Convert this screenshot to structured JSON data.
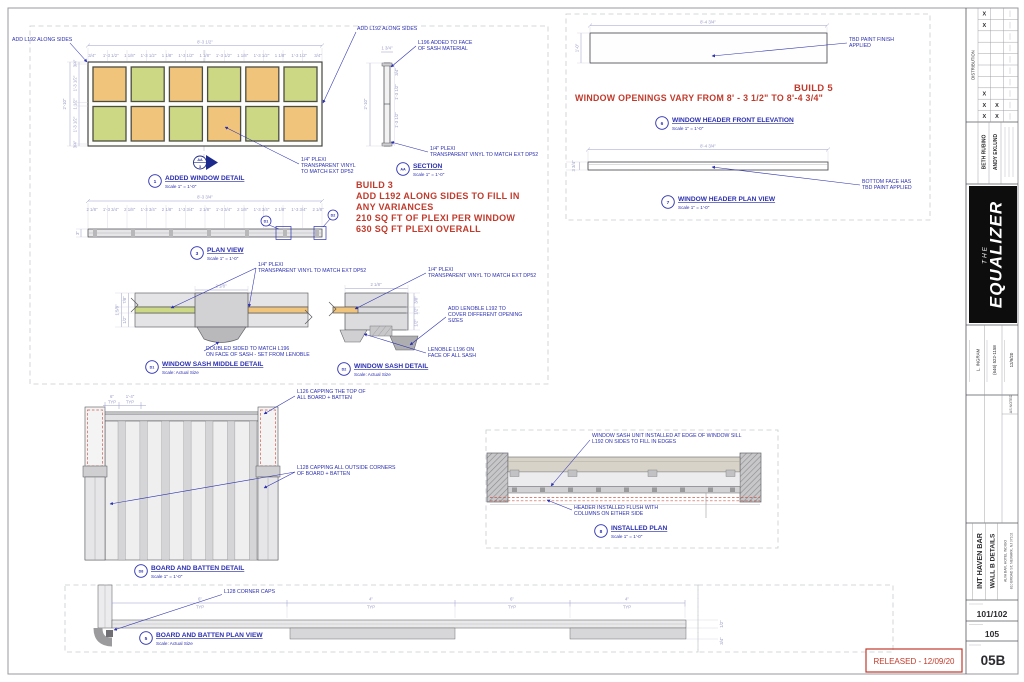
{
  "sheet": {
    "released": "RELEASED - 12/09/20"
  },
  "red": {
    "build3": [
      "BUILD 3",
      "ADD L192 ALONG SIDES TO FILL IN",
      "ANY VARIANCES",
      "210 SQ FT OF PLEXI PER WINDOW",
      "630 SQ FT PLEXI OVERALL"
    ],
    "build5_title": "BUILD 5",
    "build5_note": "WINDOW OPENINGS VARY FROM 8' - 3 1/2\" TO 8'-4 3/4\""
  },
  "details": {
    "added_window": {
      "num": "1",
      "title": "ADDED WINDOW DETAIL",
      "scale": "Scale 1\" = 1'-0\""
    },
    "section": {
      "num": "AA",
      "title": "SECTION",
      "scale": "Scale 1\" = 1'-0\""
    },
    "plan_view": {
      "num": "3",
      "title": "PLAN VIEW",
      "scale": "Scale 1\" = 1'-0\""
    },
    "sash_middle": {
      "num": "D1",
      "title": "WINDOW SASH MIDDLE DETAIL",
      "scale": "Scale: Actual Size"
    },
    "sash": {
      "num": "D2",
      "title": "WINDOW SASH DETAIL",
      "scale": "Scale: Actual Size"
    },
    "header_front": {
      "num": "6",
      "title": "WINDOW HEADER FRONT ELEVATION",
      "scale": "Scale 1\" = 1'-0\""
    },
    "header_plan": {
      "num": "7",
      "title": "WINDOW HEADER PLAN VIEW",
      "scale": "Scale 1\" = 1'-0\""
    },
    "bnb": {
      "num": "D8",
      "title": "BOARD AND BATTEN DETAIL",
      "scale": "Scale 1\" = 1'-0\""
    },
    "installed": {
      "num": "8",
      "title": "INSTALLED PLAN",
      "scale": "Scale 1\" = 1'-0\""
    },
    "bnb_plan": {
      "num": "5",
      "title": "BOARD AND BATTEN PLAN VIEW",
      "scale": "Scale: Actual Size"
    }
  },
  "section_marker": {
    "top": "AA",
    "bottom": "3"
  },
  "callouts": {
    "d1_tag": "D1",
    "d2_tag": "D2"
  },
  "notes": {
    "add_l192_a": "ADD L192 ALONG SIDES",
    "add_l192_b": "ADD L192 ALONG SIDES",
    "l196_face": [
      "L196 ADDED TO FACE",
      "OF SASH MATERIAL"
    ],
    "plexi_win": [
      "1/4\" PLEXI",
      "TRANSPARENT VINYL",
      "TO MATCH EXT DP52"
    ],
    "plexi_sec": [
      "1/4\" PLEXI",
      "TRANSPARENT VINYL TO MATCH EXT DP52"
    ],
    "plexi_d1": [
      "1/4\" PLEXI",
      "TRANSPARENT VINYL TO MATCH EXT DP52"
    ],
    "doubled": [
      "DOUBLED SIDED TO MATCH L196",
      "ON FACE OF SASH - SET FROM LENOBLE"
    ],
    "plexi_d2": [
      "1/4\" PLEXI",
      "TRANSPARENT VINYL TO MATCH EXT DP52"
    ],
    "lenoble_cover": [
      "ADD LENOBLE L192 TO",
      "COVER DIFFERENT OPENING",
      "SIZES"
    ],
    "lenoble_face": [
      "LENOBLE L196 ON",
      "FACE OF ALL SASH"
    ],
    "tbd_paint": [
      "TBD PAINT FINISH",
      "APPLIED"
    ],
    "bottom_face": [
      "BOTTOM FACE HAS",
      "TBD PAINT APPLIED"
    ],
    "l126": [
      "L126 CAPPING THE TOP OF",
      "ALL BOARD + BATTEN"
    ],
    "l128_out": [
      "L128 CAPPING ALL OUTSIDE CORNERS",
      "OF BOARD + BATTEN"
    ],
    "sash_unit": [
      "WINDOW SASH UNIT INSTALLED AT EDGE OF WINDOW SILL",
      "L192 ON SIDES TO FILL IN EDGES"
    ],
    "header_flush": [
      "HEADER INSTALLED FLUSH WITH",
      "COLUMNS ON EITHER SIDE"
    ],
    "l128_caps": "L128 CORNER CAPS"
  },
  "dims": {
    "win_w": "8'-3 1/2\"",
    "win_top": [
      "3/4\"",
      "1'-3 1/2\"",
      "1 1/8\"",
      "1'-3 1/2\"",
      "1 1/8\"",
      "1'-3 1/2\"",
      "1 1/8\"",
      "1'-3 1/2\"",
      "1 1/8\"",
      "1'-3 1/2\"",
      "1 1/8\"",
      "1'-3 1/2\"",
      "3/4\""
    ],
    "win_h": "2'-10\"",
    "win_left": [
      "3/4\"",
      "1'-3 1/2\"",
      "1 1/2\"",
      "1'-3 1/2\"",
      "3/4\""
    ],
    "sec_top": "1 3/4\"",
    "sec_left": "2'-10\"",
    "sec_right": [
      "3/4\"",
      "1'-3 1/2\"",
      "1'-3 1/2\""
    ],
    "plan_w": "8'-3 3/4\"",
    "plan_top": [
      "2 1/8\"",
      "1'-3 3/4\"",
      "2 1/8\"",
      "1'-3 3/4\"",
      "2 1/8\"",
      "1'-3 3/4\"",
      "2 1/8\"",
      "1'-3 3/4\"",
      "2 1/8\"",
      "1'-3 3/4\"",
      "2 1/8\"",
      "1'-3 3/4\"",
      "2 1/8\""
    ],
    "plan_h": "3\"",
    "d1_w": "2 1/8\"",
    "d1_left": [
      "1 5/8\"",
      "7/8\"",
      "1/2\""
    ],
    "d2_w": "2 1/8\"",
    "d2_right": [
      "3/8\"",
      "1/2\"",
      "1/2\""
    ],
    "hdr_w": "8'-4 3/4\"",
    "hdr_h": "1'-0\"",
    "hdrplan_w": "8'-4 3/4\"",
    "hdrplan_h": "3 3/4\"",
    "bnb_d1": "6\"",
    "bnb_d2": "1'-4\"",
    "typ": "TYP",
    "bnbplan": [
      "6\"",
      "4\"",
      "6\"",
      "4\""
    ],
    "bnbplan_end": [
      "1/2\"",
      "3/4\""
    ]
  },
  "colors": {
    "pane_orange": "#f0c47b",
    "pane_green": "#ccd883",
    "note_blue": "#2b2fb0",
    "red": "#c23a2b"
  },
  "titleblock": {
    "distribution": "DISTRIBUTION",
    "x_mark": "X",
    "names": [
      "BETH RUBINO",
      "ANDY EKLUND"
    ],
    "logo_the": "THE",
    "logo_name": "EQUALIZER",
    "fields": [
      "L. INGRAM",
      "(646) 522-1158",
      "12/9/20"
    ],
    "scale_note": "AS NOTED",
    "show_title": "INT HAVEN BAR",
    "sheet_title": "WALL B DETAILS",
    "addr1": "ALVA BAR, HOTEL INDIGO",
    "addr2": "810 BROAD ST, NEWARK, NJ 07102",
    "set_num": "101/102",
    "sheet_num": "105",
    "sheet_code": "05B"
  }
}
